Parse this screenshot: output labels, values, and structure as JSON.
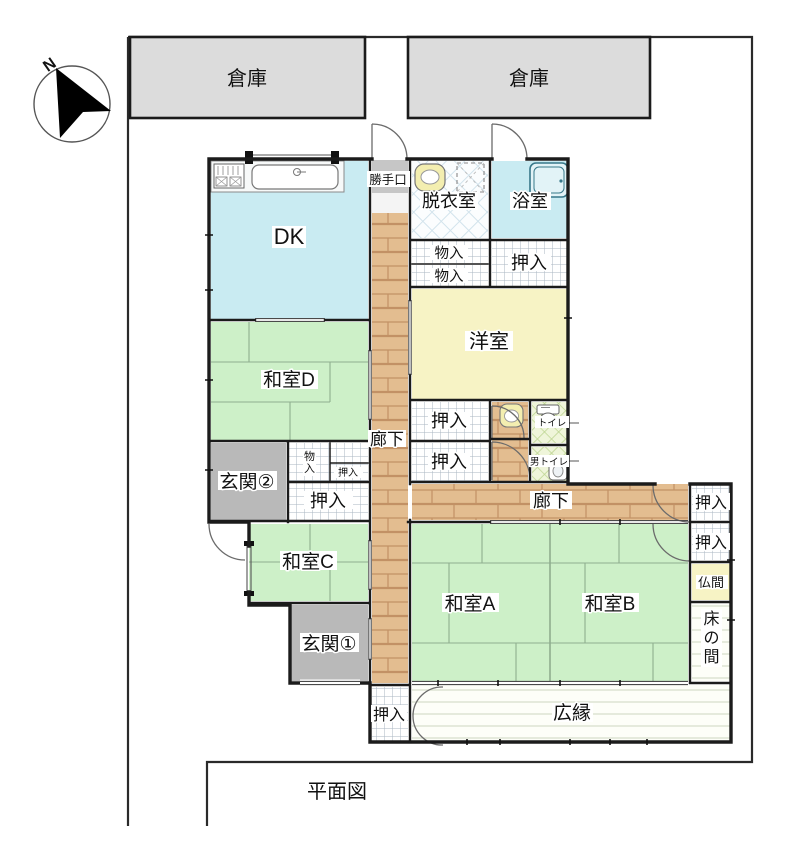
{
  "page": {
    "title": "平面図"
  },
  "compass": {
    "north": "N"
  },
  "site": {
    "storage_left": "倉庫",
    "storage_right": "倉庫"
  },
  "rooms": {
    "dk": "DK",
    "katteguchi": "勝手口",
    "datsuishitsu": "脱衣室",
    "yokushitsu": "浴室",
    "mononyu1": "物入",
    "mononyu2": "物入",
    "oshiire_bath": "押入",
    "youshitsu": "洋室",
    "oshiire_w1": "押入",
    "oshiire_w2": "押入",
    "toilet": "トイレ",
    "mens_toilet": "男トイレ",
    "rouka_west": "廊下",
    "washitsu_d": "和室D",
    "genkan2": "玄関②",
    "mononyu_small": "物入",
    "oshiire_small": "押入",
    "oshiire_mid": "押入",
    "washitsu_c": "和室C",
    "genkan1": "玄関①",
    "rouka_south": "廊下",
    "washitsu_a": "和室A",
    "washitsu_b": "和室B",
    "oshiire_e1": "押入",
    "oshiire_e2": "押入",
    "butsuma": "仏間",
    "tokonoma": "床の間",
    "oshiire_s": "押入",
    "hiroen": "広縁"
  },
  "colors": {
    "tatami_green": "#cdf0c8",
    "water_blue": "#c9ebf2",
    "western_yellow": "#f7f3c5",
    "entrance_gray": "#b9b9b9",
    "storage_gray": "#dcdcdc",
    "step_gray": "#c6c6c6",
    "wood_tan": "#e3bd90"
  }
}
